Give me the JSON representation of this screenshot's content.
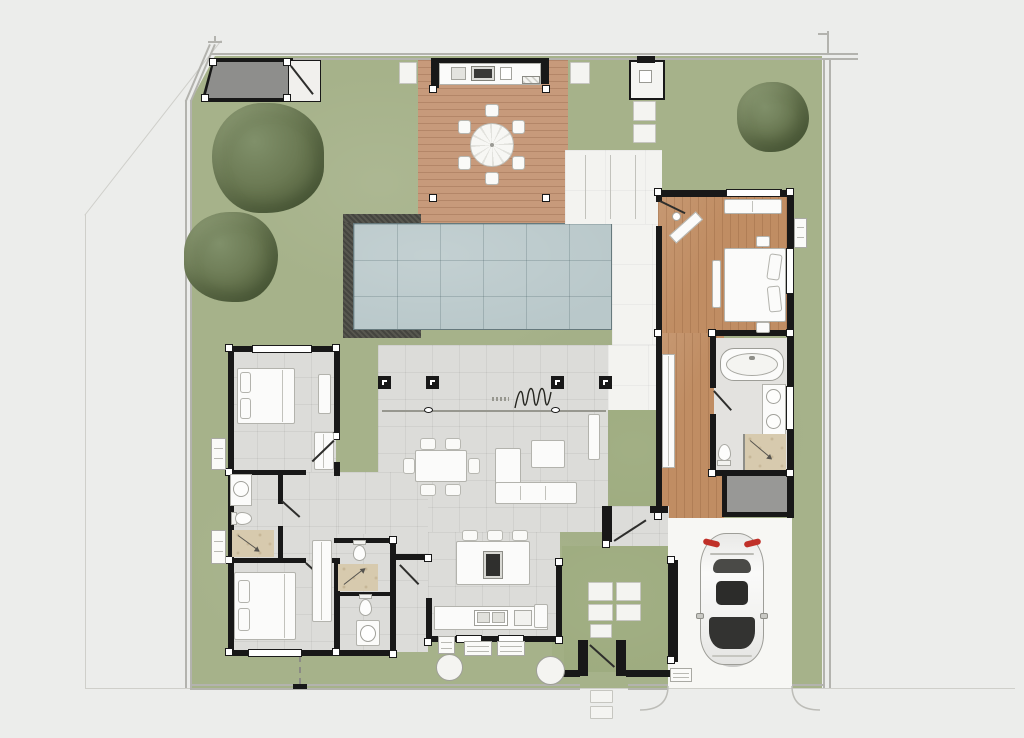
{
  "meta": {
    "title": "Villa floor plan — top view site plan",
    "visible_text": []
  },
  "colors": {
    "bg": "#ecedeb",
    "lawn": "#a6b28a",
    "lawn2": "#9dab7e",
    "deck": "#c79a7b",
    "wood": "#c08d63",
    "pool": "#b9c8ca",
    "tile": "#dcdcd9",
    "tileb": "#e3e2df",
    "terr": "#f3f3f0",
    "beige": "#d7caae",
    "wall": "#181818",
    "patio": "#8e8e8c",
    "storage": "#989896",
    "furn": "#fbfbfa",
    "furnline": "#b3b3ad",
    "bline": "#b3b3ae",
    "bfaint": "#cfcfca",
    "tree": "#67754f",
    "car_body": "#f2f2f1",
    "car_glass": "#30302e",
    "car_taillight": "#c03028"
  },
  "legend": {
    "site_features": [
      "property-boundary",
      "lawn",
      "tree",
      "canopy-patio",
      "garden-store",
      "timber-deck",
      "outdoor-dining-set",
      "outdoor-kitchen",
      "swimming-pool",
      "pool-coping",
      "outdoor-shower-cabin",
      "stepping-stones",
      "covered-terrace",
      "planted-courtyard",
      "entrance-gate",
      "carport",
      "parked-car",
      "driveway",
      "ac-units",
      "garden-path"
    ],
    "rooms": [
      "living-dining-room",
      "kitchen",
      "hallway",
      "master-bedroom",
      "walk-in-closet",
      "master-bathroom",
      "storage-room",
      "bedroom-2",
      "ensuite-bathroom-2",
      "bedroom-3",
      "bathroom-3",
      "guest-wc",
      "entry-foyer"
    ],
    "furniture_fixtures": [
      "double-bed",
      "bedside-table",
      "bench-seat",
      "writing-desk",
      "wardrobe",
      "sofa-l-shaped",
      "coffee-table",
      "tv-console",
      "dining-table-6-chairs",
      "kitchen-island",
      "bar-stools",
      "cooktop",
      "kitchen-sink",
      "bathtub",
      "double-vanity",
      "toilet",
      "shower",
      "washbasin",
      "sliding-door-track",
      "structural-column",
      "folding-door-symbol"
    ]
  }
}
